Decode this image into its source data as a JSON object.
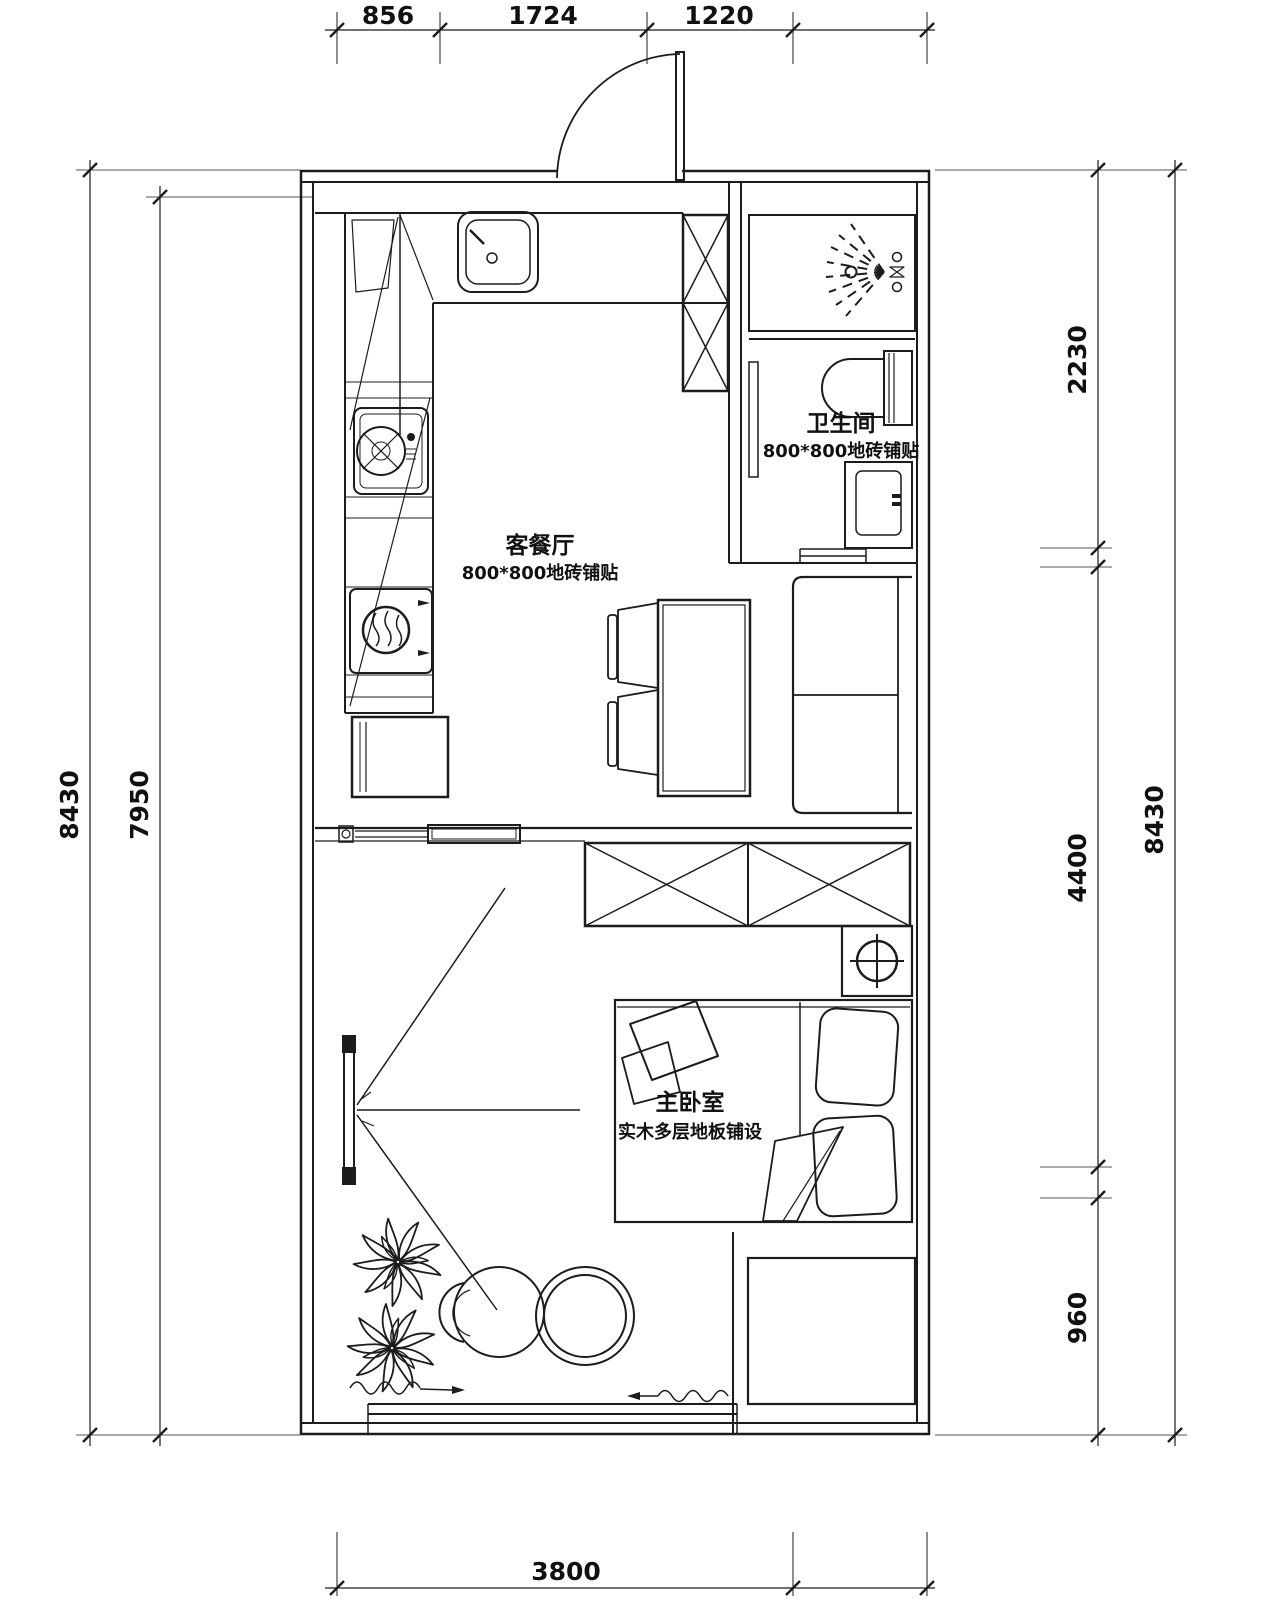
{
  "drawing": {
    "type": "apartment floor plan",
    "dims": {
      "top": [
        "856",
        "1724",
        "1220"
      ],
      "bottom": [
        "3800"
      ],
      "left": [
        "8430",
        "7950"
      ],
      "right": [
        "2230",
        "4400",
        "960",
        "8430"
      ]
    },
    "rooms": {
      "living": {
        "name": "客餐厅",
        "finish": "800*800地砖铺贴"
      },
      "bathroom": {
        "name": "卫生间",
        "finish": "800*800地砖铺贴"
      },
      "bedroom": {
        "name": "主卧室",
        "finish": "实木多层地板铺设"
      }
    },
    "colors": {
      "line": "#1c1c1c",
      "background": "#ffffff"
    }
  }
}
